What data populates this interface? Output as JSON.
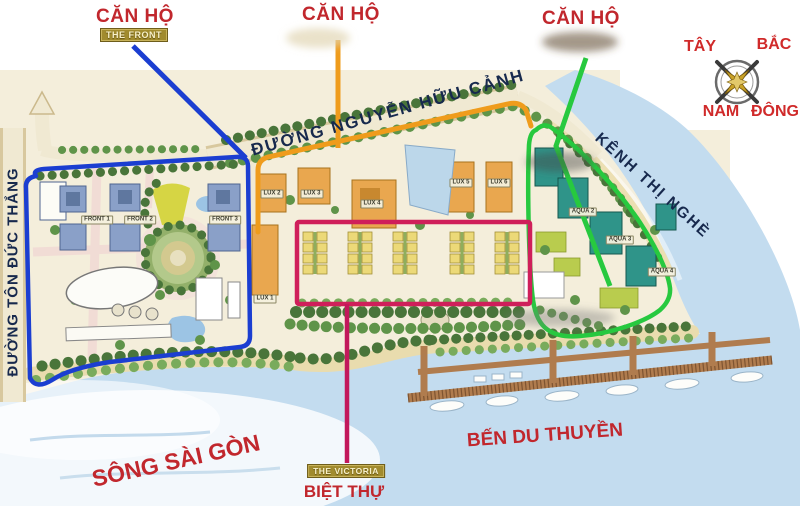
{
  "title_callouts": [
    {
      "title": "CĂN HỘ",
      "banner": "THE FRONT"
    },
    {
      "title": "CĂN HỘ",
      "banner": ""
    },
    {
      "title": "CĂN HỘ",
      "banner": ""
    }
  ],
  "compass": {
    "west": "TÂY",
    "north": "BẮC",
    "south": "NAM",
    "east": "ĐÔNG"
  },
  "roads": {
    "nguyen_huu_canh": "ĐƯỜNG NGUYỄN HỮU CẢNH",
    "ton_duc_thang": "ĐƯỜNG TÔN ĐỨC THẮNG"
  },
  "waterways": {
    "river": "SÔNG SÀI GÒN",
    "canal": "KÊNH THỊ NGHÈ"
  },
  "marina_label": "BẾN DU THUYỀN",
  "villa_callout": {
    "banner": "THE VICTORIA",
    "label": "BIỆT THỰ"
  },
  "buildings": {
    "front": [
      "FRONT 1",
      "FRONT 2",
      "FRONT 3"
    ],
    "lux": [
      "LUX 1",
      "LUX 2",
      "LUX 3",
      "LUX 4",
      "LUX 5",
      "LUX 6"
    ],
    "aqua": [
      "AQUA 2",
      "AQUA 3",
      "AQUA 4"
    ]
  },
  "zone_colors": {
    "front_zone": "#1b3ed1",
    "lux_zone": "#ef9c1c",
    "villa_zone": "#cf1f5a",
    "aqua_zone": "#27c93f"
  }
}
